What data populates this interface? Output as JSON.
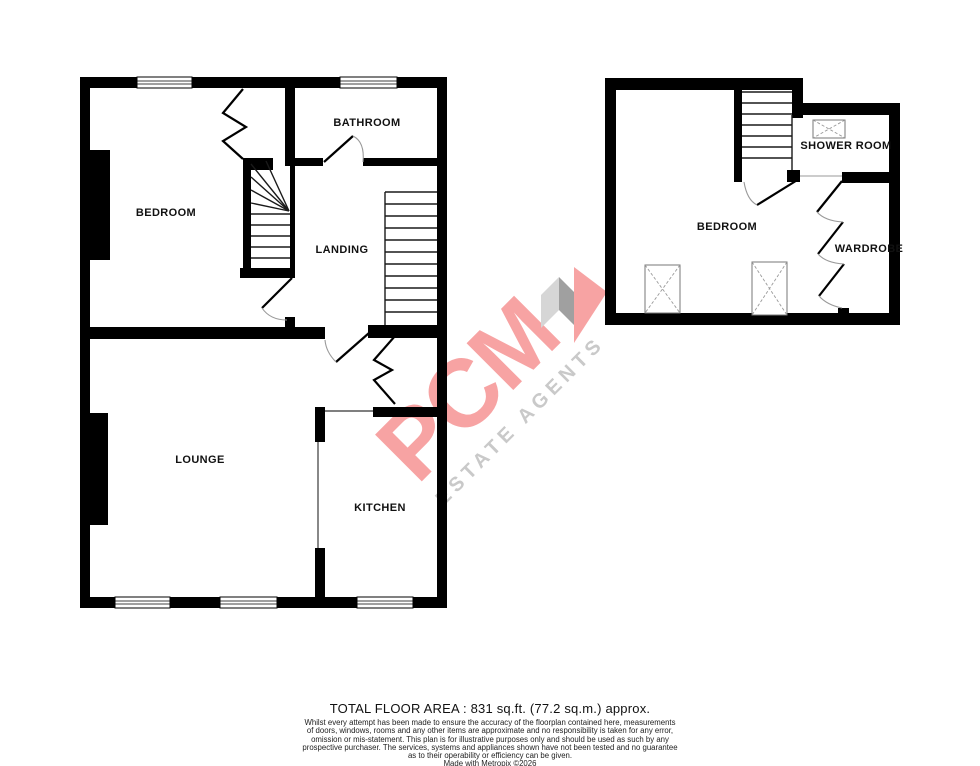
{
  "colors": {
    "wall": "#000000",
    "watermark_pink": "#f7a3a3",
    "watermark_gray": "#c9c9c9"
  },
  "watermark": {
    "brand": "PCM",
    "tagline": "ESTATE AGENTS"
  },
  "floors": {
    "first": {
      "rooms": {
        "bedroom": "BEDROOM",
        "bathroom": "BATHROOM",
        "landing": "LANDING",
        "lounge": "LOUNGE",
        "kitchen": "KITCHEN"
      }
    },
    "second": {
      "rooms": {
        "bedroom": "BEDROOM",
        "shower_room": "SHOWER ROOM",
        "wardrobe": "WARDROBE"
      }
    }
  },
  "footer": {
    "total_area": "TOTAL FLOOR AREA : 831 sq.ft. (77.2 sq.m.) approx.",
    "disclaimer_lines": [
      "Whilst every attempt has been made to ensure the accuracy of the floorplan contained here, measurements",
      "of doors, windows, rooms and any other items are approximate and no responsibility is taken for any error,",
      "omission or mis-statement. This plan is for illustrative purposes only and should be used as such by any",
      "prospective purchaser. The services, systems and appliances shown have not been tested and no guarantee",
      "as to their operability or efficiency can be given.",
      "Made with Metropix ©2026"
    ]
  }
}
